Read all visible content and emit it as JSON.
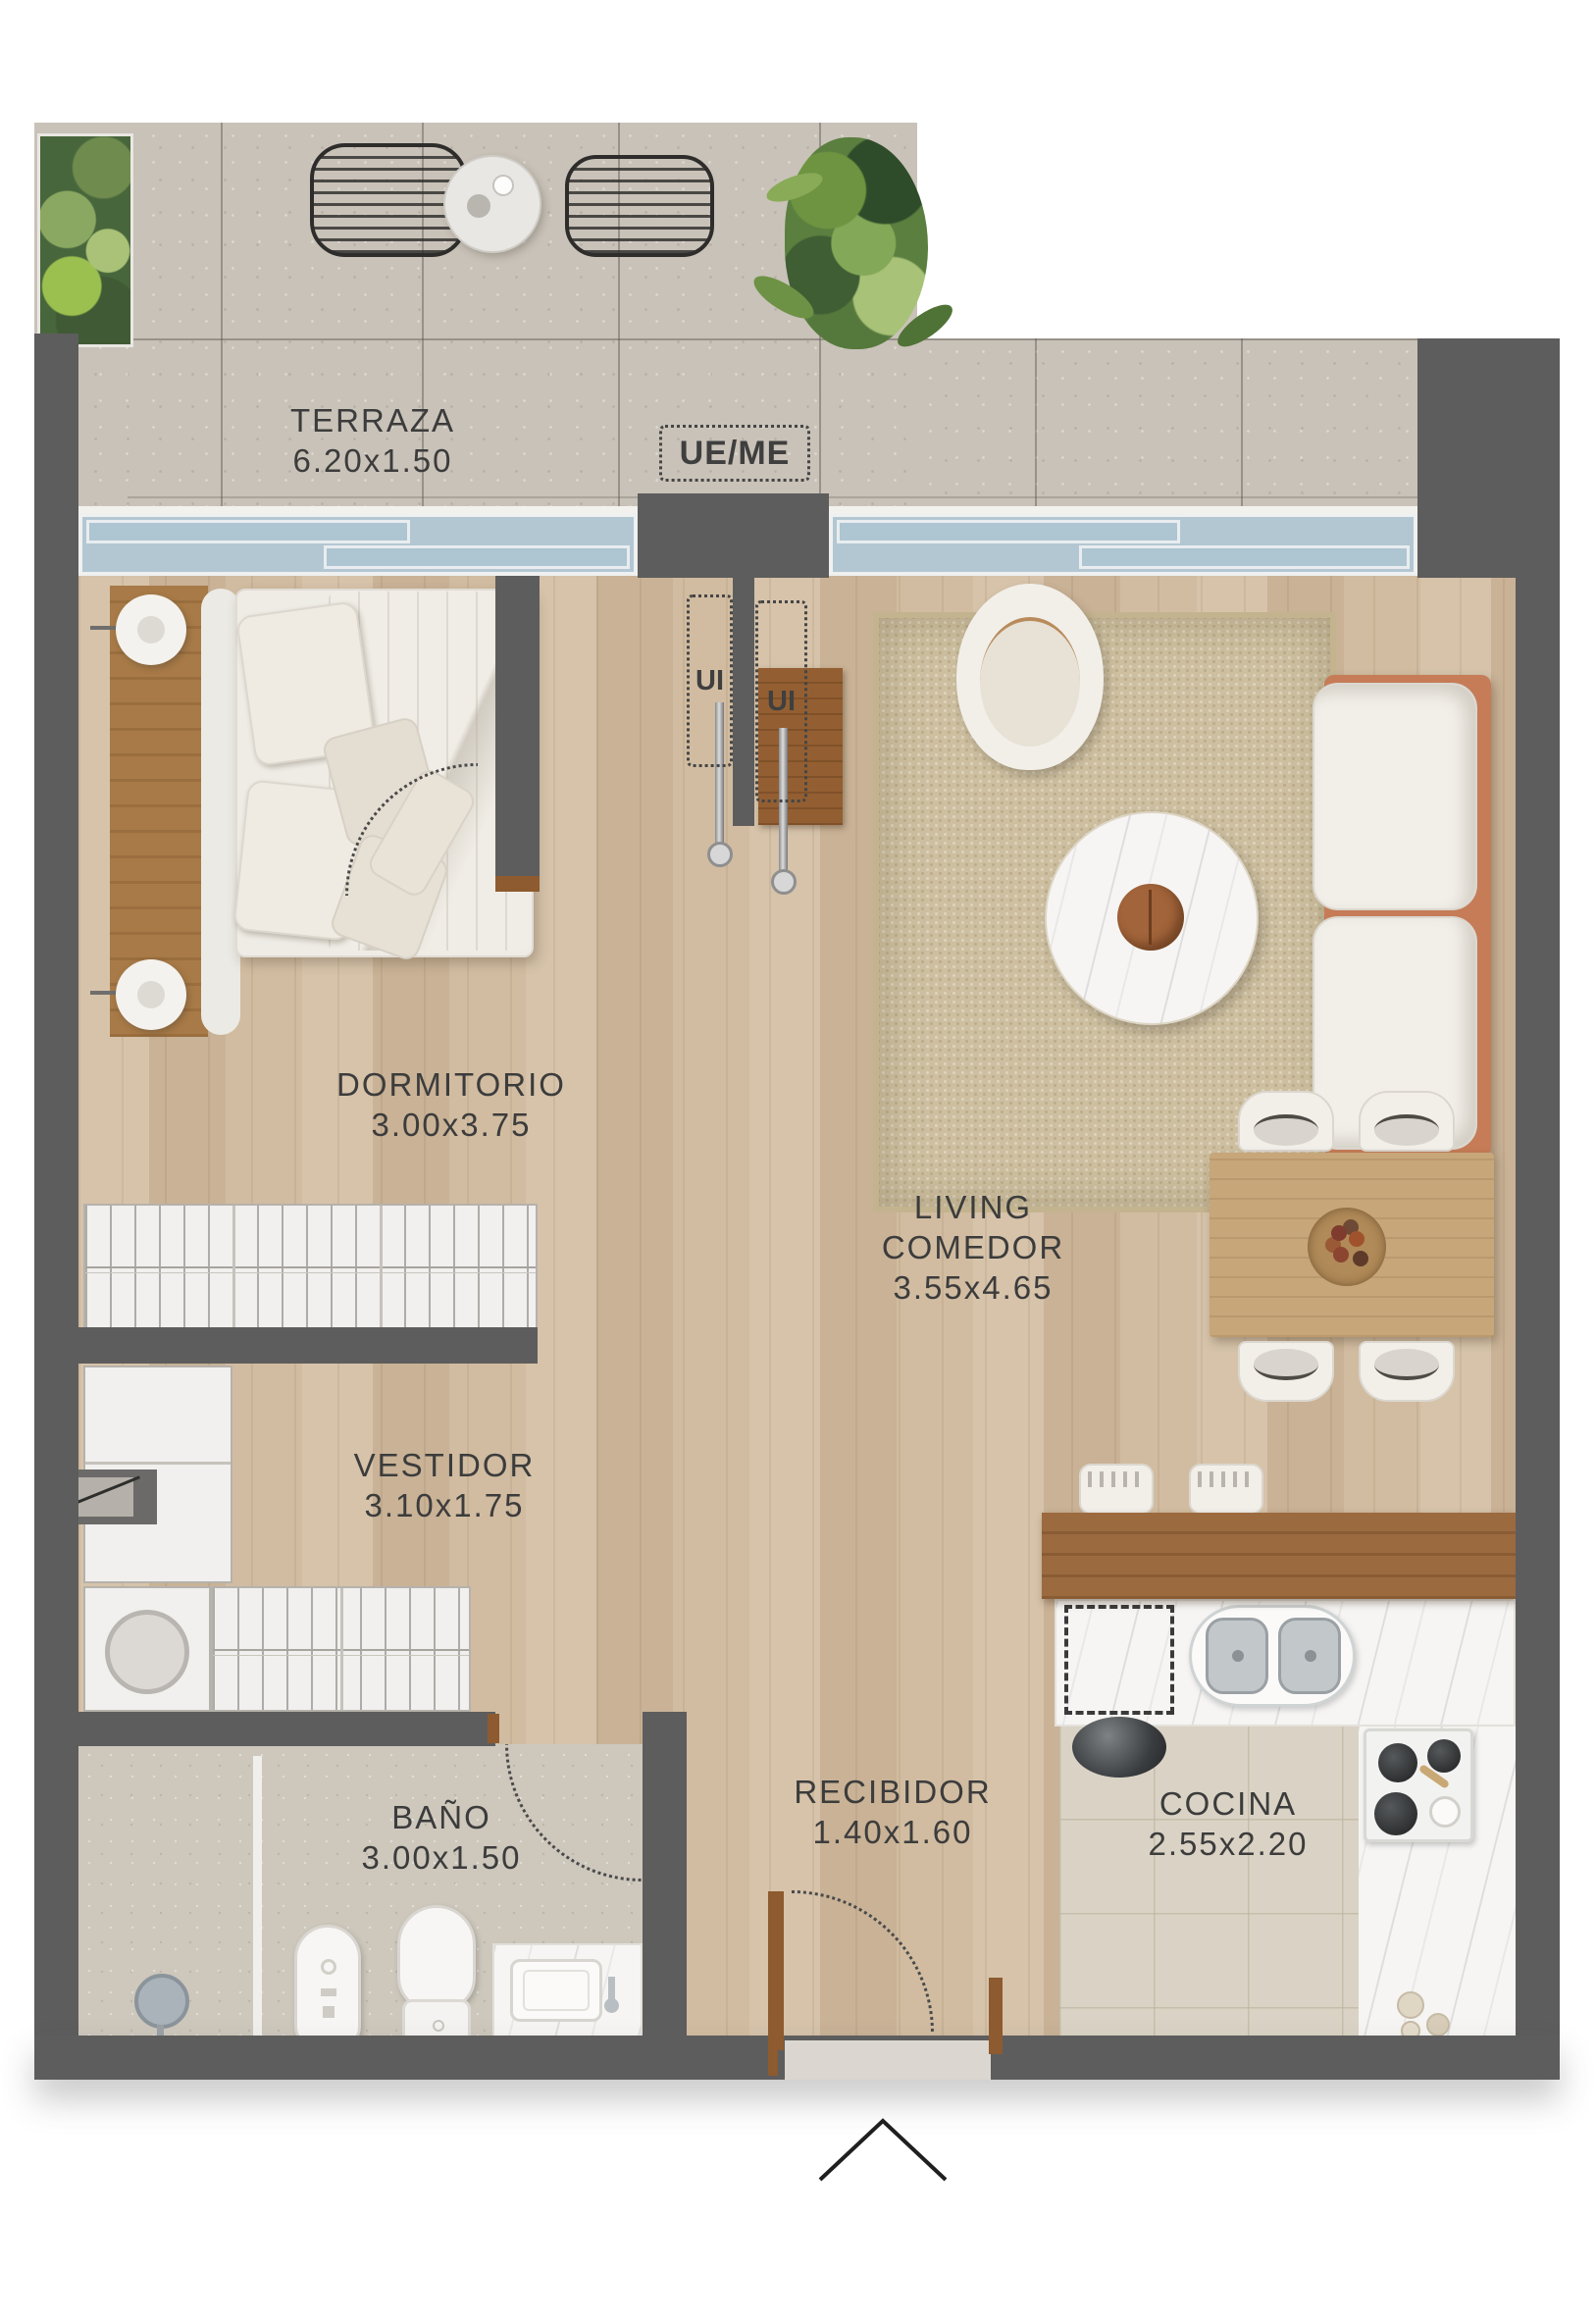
{
  "plan": {
    "rooms": {
      "terraza": {
        "name": "TERRAZA",
        "dims": "6.20x1.50"
      },
      "dormitorio": {
        "name": "DORMITORIO",
        "dims": "3.00x3.75"
      },
      "living": {
        "name1": "LIVING",
        "name2": "COMEDOR",
        "dims": "3.55x4.65"
      },
      "vestidor": {
        "name": "VESTIDOR",
        "dims": "3.10x1.75"
      },
      "bano": {
        "name": "BAÑO",
        "dims": "3.00x1.50"
      },
      "recibidor": {
        "name": "RECIBIDOR",
        "dims": "1.40x1.60"
      },
      "cocina": {
        "name": "COCINA",
        "dims": "2.55x2.20"
      }
    },
    "annotations": {
      "ue_me": "UE/ME",
      "ui_left": "UI",
      "ui_right": "UI"
    },
    "colors": {
      "wall": "#5e5d5d",
      "wood": "#cfbaa0",
      "concrete": "#c9c2b8",
      "glass": "#b3c7d3",
      "accent": "#c57c57",
      "label": "#3c3c3c"
    }
  }
}
